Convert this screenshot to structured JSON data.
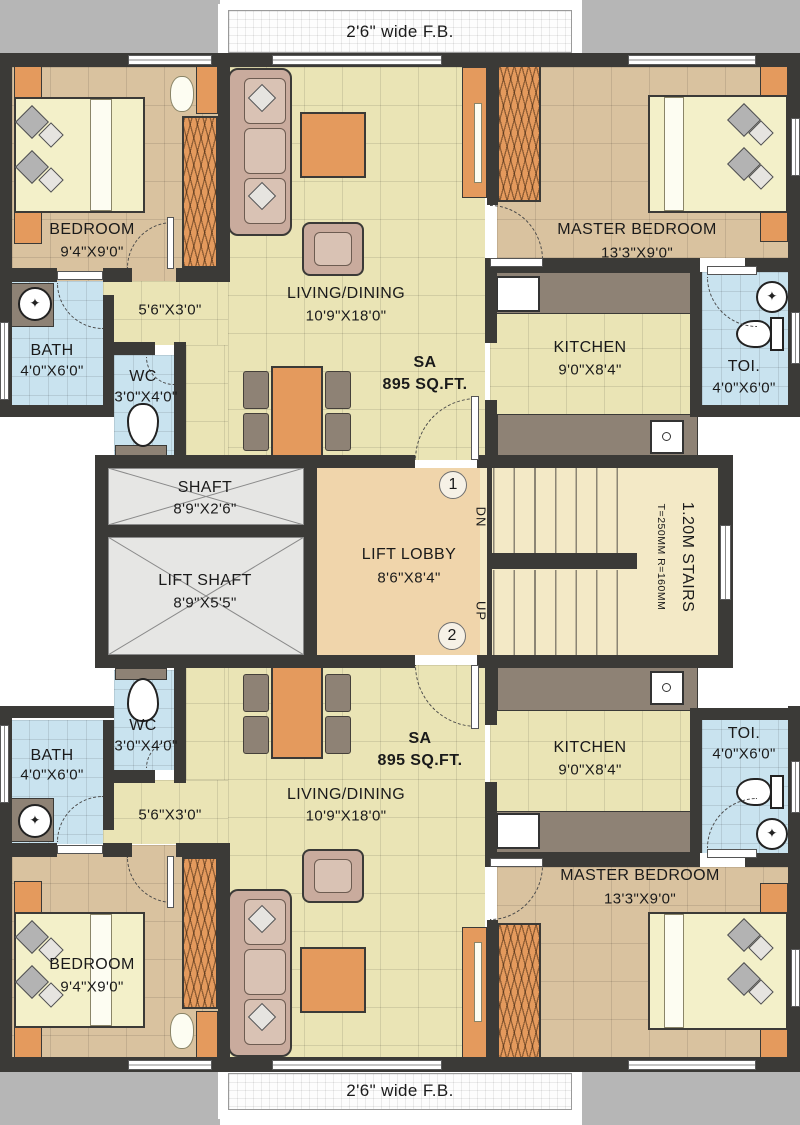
{
  "palette": {
    "wall": "#3b3a37",
    "floor_living": "#eae4b5",
    "floor_bedroom": "#d9c29f",
    "floor_bath": "#c9e3ef",
    "floor_lobby": "#f0d5ab",
    "floor_stairs": "#f3e9c6",
    "shaft_gray": "#e6e6e4",
    "furniture_orange": "#e49a5d",
    "furniture_taupe": "#8e8275",
    "sofa_mauve": "#c9ab9d",
    "bed_cream": "#f3f0c9",
    "outside_gray": "#b6b6b6"
  },
  "fb_top": {
    "label": "2'6\" wide F.B."
  },
  "fb_bottom": {
    "label": "2'6\" wide F.B."
  },
  "core": {
    "shaft_name": "SHAFT",
    "shaft_dims": "8'9\"X2'6\"",
    "lift_shaft_name": "LIFT SHAFT",
    "lift_shaft_dims": "8'9\"X5'5\"",
    "lobby_name": "LIFT LOBBY",
    "lobby_dims": "8'6\"X8'4\"",
    "stairs_name": "1.20M STAIRS",
    "stairs_note": "T=250MM R=160MM",
    "dn": "DN",
    "up": "UP",
    "flat1_marker": "1",
    "flat2_marker": "2"
  },
  "unit_top": {
    "bedroom_name": "BEDROOM",
    "bedroom_dims": "9'4\"X9'0\"",
    "bath_name": "BATH",
    "bath_dims": "4'0\"X6'0\"",
    "wc_name": "WC",
    "wc_dims": "3'0\"X4'0\"",
    "passage_dims": "5'6\"X3'0\"",
    "living_name": "LIVING/DINING",
    "living_dims": "10'9\"X18'0\"",
    "sa_label": "SA",
    "sa_area": "895 SQ.FT.",
    "kitchen_name": "KITCHEN",
    "kitchen_dims": "9'0\"X8'4\"",
    "toilet_name": "TOI.",
    "toilet_dims": "4'0\"X6'0\"",
    "master_name": "MASTER BEDROOM",
    "master_dims": "13'3\"X9'0\""
  },
  "unit_bottom": {
    "bedroom_name": "BEDROOM",
    "bedroom_dims": "9'4\"X9'0\"",
    "bath_name": "BATH",
    "bath_dims": "4'0\"X6'0\"",
    "wc_name": "WC",
    "wc_dims": "3'0\"X4'0\"",
    "passage_dims": "5'6\"X3'0\"",
    "living_name": "LIVING/DINING",
    "living_dims": "10'9\"X18'0\"",
    "sa_label": "SA",
    "sa_area": "895 SQ.FT.",
    "kitchen_name": "KITCHEN",
    "kitchen_dims": "9'0\"X8'4\"",
    "toilet_name": "TOI.",
    "toilet_dims": "4'0\"X6'0\"",
    "master_name": "MASTER BEDROOM",
    "master_dims": "13'3\"X9'0\""
  }
}
